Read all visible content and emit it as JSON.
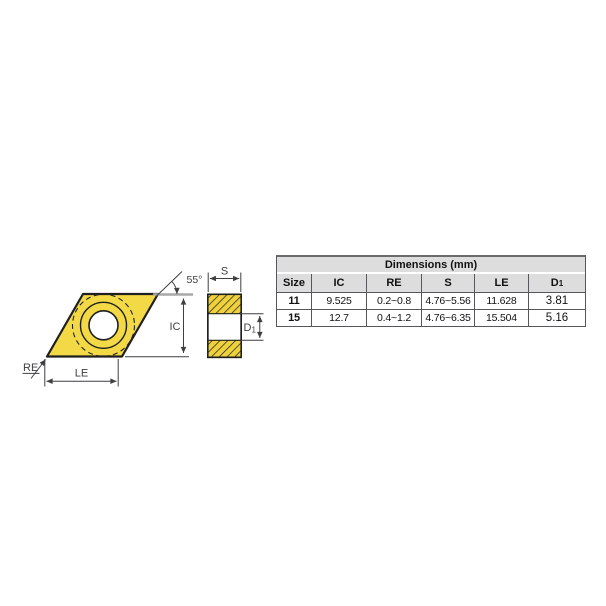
{
  "diagram": {
    "labels": {
      "angle": "55°",
      "ic": "IC",
      "re": "RE",
      "le": "LE",
      "s": "S",
      "d1": {
        "base": "D",
        "sub": "1"
      }
    },
    "colors": {
      "insert_fill": "#F3D945",
      "hatch_fill": "#EFD23B",
      "outline": "#1f1f1f",
      "dim_line": "#3d3f42",
      "angle_ref_line": "#a8a8a8"
    }
  },
  "table": {
    "title": "Dimensions (mm)",
    "header_bg": "#DDDDDD",
    "border_color": "#56575A",
    "columns": [
      {
        "label": "Size"
      },
      {
        "label": "IC"
      },
      {
        "label": "RE"
      },
      {
        "label": "S"
      },
      {
        "label": "LE"
      },
      {
        "label": "D",
        "sub": "1"
      }
    ],
    "rows": [
      {
        "size": "11",
        "ic": "9.525",
        "re": "0.2~0.8",
        "s": "4.76~5.56",
        "le": "11.628",
        "d1": "3.81"
      },
      {
        "size": "15",
        "ic": "12.7",
        "re": "0.4~1.2",
        "s": "4.76~6.35",
        "le": "15.504",
        "d1": "5.16"
      }
    ]
  }
}
